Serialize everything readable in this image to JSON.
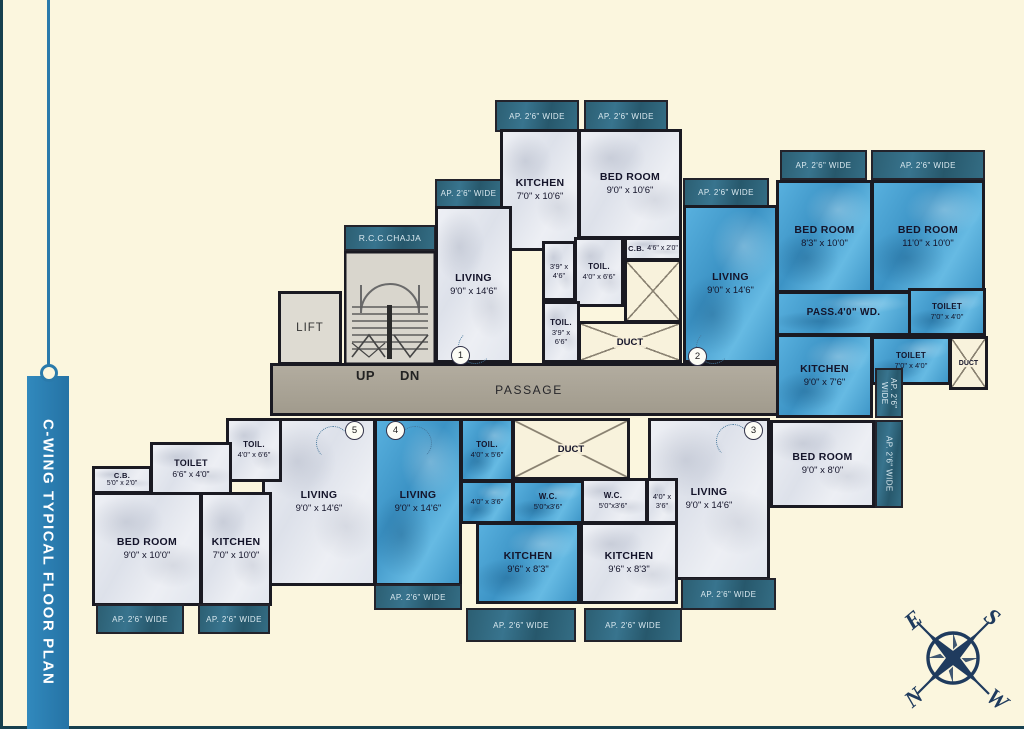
{
  "title": "C-WING TYPICAL FLOOR PLAN",
  "labels": {
    "ap": "AP. 2'6\" WIDE",
    "chajja": "R.C.C.CHAJJA",
    "lift": "LIFT",
    "up": "UP",
    "dn": "DN",
    "passage": "PASSAGE",
    "duct": "DUCT",
    "pass_wd": "PASS.4'0\" WD."
  },
  "units": [
    "1",
    "2",
    "3",
    "4",
    "5"
  ],
  "rooms": {
    "f1_kitchen": {
      "name": "KITCHEN",
      "dims": "7'0\" x 10'6\""
    },
    "f1_bedroom": {
      "name": "BED ROOM",
      "dims": "9'0\" x 10'6\""
    },
    "f1_living": {
      "name": "LIVING",
      "dims": "9'0\" x 14'6\""
    },
    "f1_shaft": {
      "name": "",
      "dims": "3'9\" x 4'6\""
    },
    "f1_toil_a": {
      "name": "TOIL.",
      "dims": "4'0\" x 6'6\""
    },
    "f1_cb": {
      "name": "C.B.",
      "dims": "4'6\" x 2'0\""
    },
    "f1_toil_b": {
      "name": "TOIL.",
      "dims": "3'9\" x 6'6\""
    },
    "f2_living": {
      "name": "LIVING",
      "dims": "9'0\" x 14'6\""
    },
    "f2_bedroom_a": {
      "name": "BED ROOM",
      "dims": "8'3\" x 10'0\""
    },
    "f2_bedroom_b": {
      "name": "BED ROOM",
      "dims": "11'0\" x 10'0\""
    },
    "f2_toilet_a": {
      "name": "TOILET",
      "dims": "7'0\" x 4'0\""
    },
    "f2_toilet_b": {
      "name": "TOILET",
      "dims": "7'0\" x 4'0\""
    },
    "f2_kitchen": {
      "name": "KITCHEN",
      "dims": "9'0\" x 7'6\""
    },
    "f3_bedroom": {
      "name": "BED ROOM",
      "dims": "9'0\" x 8'0\""
    },
    "f3_living": {
      "name": "LIVING",
      "dims": "9'0\" x 14'6\""
    },
    "f3_wc": {
      "name": "W.C.",
      "dims": "5'0\"x3'6\""
    },
    "f3_shaft": {
      "name": "",
      "dims": "4'0\" x 3'6\""
    },
    "f3_kitchen": {
      "name": "KITCHEN",
      "dims": "9'6\" x 8'3\""
    },
    "f4_living": {
      "name": "LIVING",
      "dims": "9'0\" x 14'6\""
    },
    "f4_toil": {
      "name": "TOIL.",
      "dims": "4'0\" x 5'6\""
    },
    "f4_shaft": {
      "name": "",
      "dims": "4'0\" x 3'6\""
    },
    "f4_wc": {
      "name": "W.C.",
      "dims": "5'0\"x3'6\""
    },
    "f4_kitchen": {
      "name": "KITCHEN",
      "dims": "9'6\" x 8'3\""
    },
    "f5_living": {
      "name": "LIVING",
      "dims": "9'0\" x 14'6\""
    },
    "f5_toil": {
      "name": "TOIL.",
      "dims": "4'0\" x 6'6\""
    },
    "f5_toilet": {
      "name": "TOILET",
      "dims": "6'6\" x 4'0\""
    },
    "f5_cb": {
      "name": "C.B.",
      "dims": "5'0\" x 2'0\""
    },
    "f5_bedroom": {
      "name": "BED ROOM",
      "dims": "9'0\" x 10'0\""
    },
    "f5_kitchen": {
      "name": "KITCHEN",
      "dims": "7'0\" x 10'0\""
    }
  },
  "compass": {
    "n": "N",
    "e": "E",
    "s": "S",
    "w": "W"
  }
}
